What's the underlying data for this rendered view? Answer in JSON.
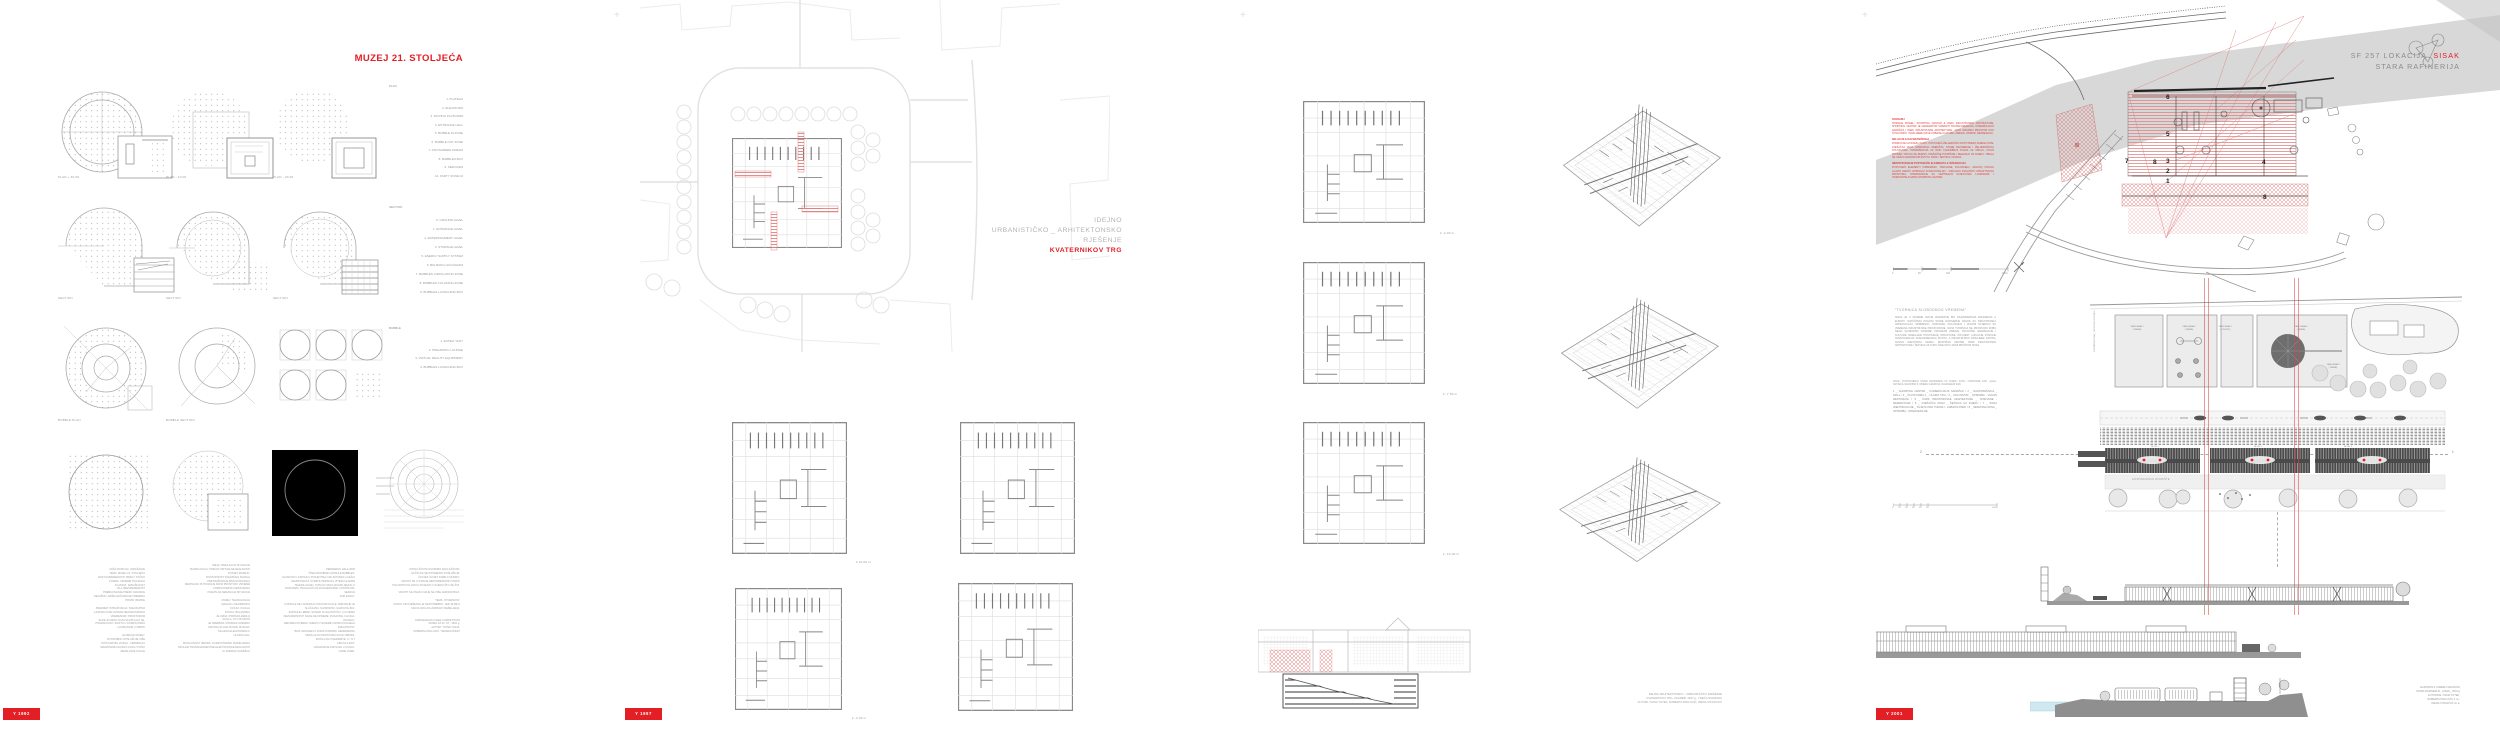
{
  "misc": {
    "reg_mark": "+"
  },
  "boards": {
    "muzej": {
      "title": "MUZEJ 21. STOLJEĆA",
      "row1_captions": [
        "PLAN + 40.00",
        "PLAN - 10.00",
        "PLAN - 20.00"
      ],
      "row2_captions": [
        "SECTION",
        "SECTION",
        "SECTION"
      ],
      "row3_captions": [
        "BUBBLE PLAN",
        "BUBBLE SECTION"
      ],
      "plan_list": {
        "label": "PLAN",
        "items": [
          "1.  PLATEAU",
          "2.  ELEVATORS",
          "3.  MOVING PLATFORM",
          "4.  ENTRANCE HALL",
          "5.  BUBBLE IN ZONE",
          "6.  BUBBLE OUT ZONE",
          "7.  INFOSCREEN DREAM",
          "8.  BUBBLES BOX",
          "9.  SERVICES",
          "10. PARTY ZONE 02"
        ]
      },
      "section_list": {
        "label": "SECTION",
        "items": [
          "0. GROUND LEVEL",
          "1. ENTRANCE LEVEL",
          "2. ENTERTAINMENT LEVEL",
          "4. STORAGE LEVEL",
          "5. ENERGY SUPPLY SYSTEM",
          "6. BIG BANG HOLOGRAM",
          "7. BUBBLES CIRCULATING ZONE",
          "8. BUBBLES COLLIDING ZONE",
          "9. BUBBLES LAUNCHING BOX"
        ]
      },
      "bubble_list": {
        "label": "BUBBLE",
        "items": [
          "1. ENTER / EXIT",
          "2. PNEUMATIC LOUNGE",
          "3. VIRTUAL REALITY EQUIPMENT",
          "4. BUBBLES LAUNCHING BOX"
        ]
      },
      "col1_text": "NAŠA POZICIJA: ZAPAŽANJE\nTEMA: MUZEJ 21. STOLJEĆA\nDAR SUVREMENOSTI: BRZO I TOČNO\nFORMA: VRIJEME TRAJANJA\nPLANOVI: SADAŠNJOST\nCILJ: BEZVREMENOST\nPREBACIVANJE PREKO GRANICE\nNEVAŽNO: NAŠE RAČUNANJE VREMENA\nPRIVID: BRZINE\n\nPREDMET ISTRAŽIVANJA: SVEUKUPNO\nLJUDSKO DJELOVANJE NEOGRANIČENO\nVREMENOM I PROSTOROM\nSLIKE SVIJETA: DATA SKUPLJAJU SE,\nPOHRANJUJU I RASTU U KOMPJUTERU\nLOCIRANOM U ORBITI\n\nGLOBALNI MUZEJ:\nISTODOBNO OPSLUŽUJE VIŠE\nISTOVJETNIH VOZILA - TERMINALA\nSMJEŠTENIH NA BILO KOJOJ TOČKI\nZEMALJSKE KUGLE",
      "col2_text": "IDEJA: SIMULACIJA SITUACIJE\nTEHNOLOGIJA: PRIKAZI VIRTUALNE REALNOSTI\nPOSJET MUZEJU:\nDOSTUPNOST SVEOPĆEG ZNANJA\nPRETRAŽIVANJE BAZA PODATAKA\nMENTALNO PUTOVANJE KROZ PROSTOR I VRIJEME\nKOMPJUTERSKI SIMULIRANA\nOSJETILNA SENZACIJA SITUACIJE\n\nMUZEJ: TEHNOLOGIJA\nMAGIJA U GEOMETRIJI\nKOCKA I KUGLA\nKOCKA: BALANSIRA\nJE CRNA I PRIPADA ZEMLJI\nKUGLA: JOY DIVISION\nJE SREBRNA I PRIPADA SVEMIRU\nKROVNA PLOHA KOCKE JE BAZA:\nSILAZAK ELEVATORIMA U\nULAZNI HALL\n\nMOGUĆNOST IZBORA: KOMPJUTERSKI MODELIRANA\nOKOLINA TRANSCENDENTNE ELEKTRONSKE REALNOSTI\nILI ZABAVNI SADRŽAJI",
      "col3_text": "PERIFERIJU HALA 2000\nČINE PROZIRNE KAPSULE BUBBLES.\nULASKOM U KAPSULU POSJETITELJ SE ZATVARA U LEŽAJ\nNEURONAUTA, KOMPJUTERSKOG VITEZA HLADNE\nTEHNOLOGIJE I TOPLOG SRCA IZGUBLJENOG U\nBUDUĆEM, TRAGAJUĆI ZA DOGAĐANJIMA U PROŠLOM.\nSEARCH\nAND ENJOY.\n\nKAPSULE SE LANSIRAJU UNUTAR KUGLE. KRETANJE JE\nSLUČAJNO, SLOBODNO, SAMOVOLJNO.\nKAPSULE LEBDE, SUDARI SU ELASTIČNI I U IX NEMA\nNEZGRAPNOSTI NAVALNE OPREME: RUKAVICE, KACIGA,\nODIJELO.\nDEFINIRA INTERES: MJESTO VRIJEME OSOBU DOGAĐAJ\nDJELATNOST.\nBIVA URONJEN U KOMPJUTERSKI GENERIRANU\nSIMULACIJU PROSTORA SVOG IZBORA.\nMONA LISA OVERDRIVE: X / N ?\nCIRCULA EXIT.\nUSISAVANJE KAPSULE U KUGLU.\nGAME OVER.",
      "col4_text": "ISTINU ŽIVOTA IZVODIMO ZAKLJUČKOM.\nNAČIN DA SE POSREDNO POSLUŽUJE.\nČOVJEK SVIJET STABLO MUDRO.\nVRATITI SE U STANJE NEPOSREDNOSTI ZNAČI\nPOLOMITI POLOVICU SVIJESTI O SVEMU ŠTO SE ŽIVI.\n\nVRATITI SE ONAKO GDJE SE VIŠE JEDNOM BILO.\n\nTEMA: STVARNOST.\nSVAKO OD RJEŠENJA JE NEPOTREBNO, JER JE BILO\nKAKVA ODLUKA ZAPRAVO NEŽELJENA.\n\n\nSHINKENCHIKU IDEA COMPETITION\nMUZEJ ZA 21. ST., 1992.g.\nAUTORI: TUTEK IVANA,\nROBERTA PAVLOVIĆ, TAMARA RODIĆ",
      "badge": "Y 1992"
    },
    "kvaternik": {
      "title_lines": [
        "IDEJNO",
        "URBANISTIČKO _ ARHITEKTONSKO",
        "RJEŠENJE"
      ],
      "title_red": "KVATERNIKOV TRG",
      "level_captions": [
        "k ±0.00 m",
        "k -3.00 m",
        "k -4.00 m",
        "k -7.50 m",
        "k -10.00 m"
      ],
      "credits": "IDEJNO ARHITEKTONSKO - URBANISTIČKO RJEŠENJE\nKVATERNIKOV TRG, ZAGREB, 1997.g., TREĆA NAGRADA\nAUTORI: IVANA TUTEK, ROBERTA PAVLOVIĆ, IRENA VITASOVIĆ",
      "badge": "Y 1997"
    },
    "sisak": {
      "title_prefix": "SF 257   LOKACIJA",
      "title_red": "SISAK",
      "title_line2": "STARA  RAFINERIJA",
      "red_sections": [
        {
          "heading": "SCENARIJ",
          "body": "HOMAGE MODEL: SHOPPING CENTAR & PARK INDUSTRIJSKE ARHITEKTURE. SHOPPING CENTAR JE GENERATOR URBANIH TRANSFORMACIJA. KOMERCIJALNI SADRŽAJI I PARK INDUSTRIJSKE ARHITEKTURE: JAVNI GRADSKI PROSTOR KOJI ČUVA PRIČU I NASLIJEĐE NOVE URBANE KULTURE. ZABAVA, ODMOR, REKREACIJA."
        },
        {
          "heading": "RELACIJE & RAZGRANIČENJA",
          "body": "PODRUČJE UZ RIJEKU KUPU: POSTOJEĆI ŽELJEZNIČKI MOST PREKO RIJEKE KUPE. PJEŠAČKA VEZA GRADSKOG SREDIŠTA, STARE RAFINERIJE I ŽELJEZNIČKOG KOLODVORA. INTERVENCIJA UZ RUB: FLEKSIBILNI POJAS UZ OBALU, KOLNI PROMET ODVIJA SE RUBNO, PJEŠAČKE POVRŠINE I ZELENILO UZ RIJEKU. OBALA SE VRAĆA GRADSKOM ŽIVOTU: PARK / ŠETNICA / RIJEKA."
        },
        {
          "heading": "IDENTIFICIRANJE POSTOJEĆIH ELEMENATA & INTERAKCIJA",
          "body": "POSTOJEĆI ELEMENTI (SPREMNICI, TANKVANE, KOLOSIJECI, VAGONI) OSTAJU GLAVNI IGRAČI: DOBIVAJU FUNKCIONALNO - VIZUALNU KVALITETU ATRAKTIVNOG PROSTORA. INTERVENCIJE SU VERTIKALNI SVJETLOSNI 'LANDMARK' I HORIZONTALNI ZIDNI SHOPPING CENTAR."
        }
      ],
      "scalebar1": [
        "0",
        "50",
        "100",
        "200m"
      ],
      "factory_heading": "\"TVORNICA SLOBODNOG VREMENA\"",
      "factory_text": "SISAK JE U VRIJEME SVOJE IZGRADNJE BIO NAJMODERNIJA RAFINERIJA U EUROPI. NAPUŠTENI POGONI STARE RAFINERIJE DANAS SU INDUSTRIJSKA ARHEOLOGIJA: SPREMNICI, TANKVANE, KOLOSIJECI I VAGONI SVJEDOCI SU VREMENA INDUSTRIJSKE PROIZVODNJE. NOVA TVORNICA NE PROIZVODI ROBU NEGO SLOBODNO VRIJEME: PROGRAM ZABAVE, TRGOVINE, REKREACIJE I KULTURE NASELJAVA POSTOJEĆE STRUKTURE. POVIJEST LOKACIJE POSTAJE SCENOGRAFIJA SVAKODNEVNOG ŽIVOTA, A INDUSTRIJSKO NASLIJEĐE KAPITAL NOVOG IDENTITETA GRADA. SHOPPING CENTAR, PARK INDUSTRIJSKE ARHITEKTURE I ŠETNICA UZ KUPU ČINE NOVI JAVNI PROSTOR SISKA.",
      "legend_note": "SISAK: POSTROJENJA STARE RAFINERIJE UZ RIJEKU KUPU, OSNOVANE 1927. godine. NATJEČAJ EUROPAN 6: IZMEĐU GRADOVA, NAGRAĐENI RAD.",
      "legend": "1 _ SHOPPING CENTAR _ KOMERCIJALNI SADRŽAJI / 2 _ NADSTREŠNICA _ WALL / 3 _ PLATFORMA 1 _ ULAZNI TRG / 4 _ KOLODVOR _ OPSKRBA - VAGON RESTORANI / 5 _ PARK INDUSTRIJSKE ARHITEKTURE _ TANKVANE - REZERVOARI / 6 _ PJEŠAČKA ZONA _ ŠETNICA UZ RIJEKU / 7 _ ZONA IDENTIFIKACIJE _ SVJETLOSNI TORANJ - ZABAVNI PARK / 8 _ SERVISNA ZONA _ OPSKRBA - INTERVENCIJE",
      "scalebar2": [
        "0",
        "10",
        "20",
        "30",
        "40",
        "50",
        "100m"
      ],
      "map_numbers": [
        "6",
        "5",
        "7",
        "8",
        "3",
        "2",
        "1",
        "4",
        "8"
      ],
      "plan_labels": {
        "t1": "TANKVANA 1\n(TRAVA)",
        "t2": "TANKVANA 2\n(TRAVA)",
        "t3": "TANKVANA 3\n(CVIJEĆE)",
        "t4": "TANKVANA 4\n(TRAVA)",
        "t5": "TANKVANA 5\n(TRAVA)",
        "blok1": "BLOK 1",
        "blok2": "BLOK 2",
        "blok3": "BLOK 3",
        "dvoriste": "GOSPODARSKO DVORIŠTE",
        "zona": "PJEŠAČKA ZONA _ ŠETNICA UZ RIJEKU"
      },
      "section_labels": {
        "left": "2",
        "right": "1"
      },
      "credits": "EUROPAN 6: IZMEĐU GRADOVA\nSTARA RAFINERIJA _SISAK_ 2001.g\nAUTORICE: IVANA TUTEK,\nROBERTA PAVLOVIĆ d.i.a.,\nIRENA VITASOVIĆ d.i.a.",
      "badge": "Y 2001"
    }
  }
}
